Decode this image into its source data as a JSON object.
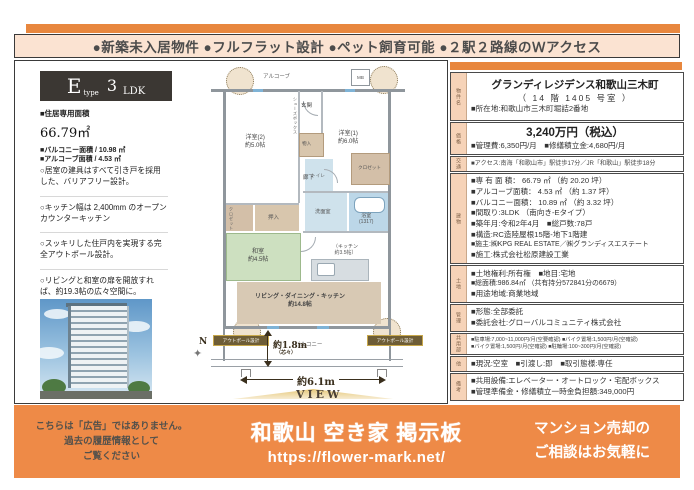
{
  "header": {
    "features": "●新築未入居物件 ●フルフラット設計 ●ペット飼育可能 ●２駅２路線のＷアクセス"
  },
  "unit_panel": {
    "type_letter": "E",
    "type_word": "type",
    "type_number": "3",
    "type_ldk": "LDK",
    "area_label": "■住居専用面積",
    "area_value": "66.79",
    "area_unit": "㎡",
    "balcony_line": "■バルコニー面積 / 10.98 ㎡",
    "alcove_line": "■アルコーブ面積 / 4.53 ㎡",
    "points": [
      "○居室の建具はすべて引き戸を採用した、バリアフリー設計。",
      "○キッチン幅は 2,400mm のオープンカウンターキッチン",
      "○スッキリした住戸内を実現する完全アウトポール設計。",
      "○リビングと和室の扉を開放すれば、約19.3帖の広々空間に。"
    ]
  },
  "floor_plan": {
    "alcove": "アルコーブ",
    "mb": "MB",
    "entrance": "玄関",
    "shoes": "シューズボックス",
    "storage": "物入",
    "west_room": "洋室(2)",
    "west_room_size": "約5.0帖",
    "east_room": "洋室(1)",
    "east_room_size": "約6.0帖",
    "hallway": "廊下",
    "toilet": "トイレ",
    "closet_west": "クロゼット",
    "closet_east": "クロゼット",
    "oshiire": "押入",
    "washroom": "洗面室",
    "bath": "浴室",
    "bath_size": "(1317)",
    "japanese_room": "和室",
    "japanese_room_size": "約4.5帖",
    "kitchen_1": "（キッチン",
    "kitchen_2": "約3.5帖）",
    "ldk": "リビング・ダイニング・キッチン",
    "ldk_size": "約14.8帖",
    "balcony": "バルコニー",
    "outpole": "アウトポール設計",
    "depth": "約1.8m",
    "depth_note": "（芯々）",
    "width": "約6.1m",
    "view": "VIEW",
    "north": "N"
  },
  "details": [
    {
      "label": "物件名",
      "lines": [
        "グランディレジデンス和歌山三木町",
        "（ 14 階 1405 号室 ）",
        "■所在地:和歌山市三木町堀詰2番地"
      ]
    },
    {
      "label": "価格",
      "lines": [
        "3,240万円（税込）",
        "■管理費:6,350円/月　■修繕積立金:4,680円/月"
      ]
    },
    {
      "label": "交通",
      "lines": [
        "■アクセス:南海「和歌山市」駅徒歩17分／JR「和歌山」駅徒歩18分"
      ]
    },
    {
      "label": "建物",
      "lines": [
        "■専 有 面 積： 66.79 ㎡ （約 20.20 坪）",
        "■アルコーブ面積： 4.53 ㎡ （約 1.37 坪）",
        "■バルコニー面積： 10.89 ㎡ （約 3.32 坪）",
        "■間取り:3LDK （南向き-Eタイプ）",
        "■築年月:令和2年4月　■総戸数:78戸",
        "■構造:RC造陸屋根15階-地下1階建",
        "■施主:㈱KPG REAL ESTATE／㈱グランディスエステート",
        "■施工:株式会社松原建設工業"
      ]
    },
    {
      "label": "土地",
      "lines": [
        "■土地権利:所有権　■地目:宅地",
        "■総面積:986.84㎡ （共有持分572841分の6679）",
        "■用途地域:商業地域"
      ]
    },
    {
      "label": "管理",
      "lines": [
        "■形態:全部委託",
        "■委託会社:グローバルコミュニティ株式会社"
      ]
    },
    {
      "label": "共用部",
      "lines": [
        "■駐車場:7,000~11,000円/月(空要確認) ■バイク置場:1,500円/月(空確認)",
        "■バイク置場:1,500円/月(空確認) ■駐輪場:100~300円/月(空確認)"
      ]
    },
    {
      "label": "他",
      "lines": [
        "■現況:空室　■引渡し:即　■取引態様:専任"
      ]
    },
    {
      "label": "備考",
      "lines": [
        "■共用設備:エレベーター・オートロック・宅配ボックス",
        "■管理準備金・修繕積立一時金負担額:349,000円"
      ]
    }
  ],
  "banner": {
    "disclaimer_1": "こちらは「広告」ではありません。",
    "disclaimer_2": "過去の履歴情報として",
    "disclaimer_3": "ご覧ください",
    "title": "和歌山 空き家 掲示板",
    "url": "https://flower-mark.net/",
    "pitch_1": "マンション売却の",
    "pitch_2": "ご相談はお気軽に"
  },
  "colors": {
    "accent_orange": "#e8873e",
    "banner_orange": "#ee8a47",
    "header_bg": "#fbe3d2",
    "label_bg": "#f6d3b8"
  }
}
